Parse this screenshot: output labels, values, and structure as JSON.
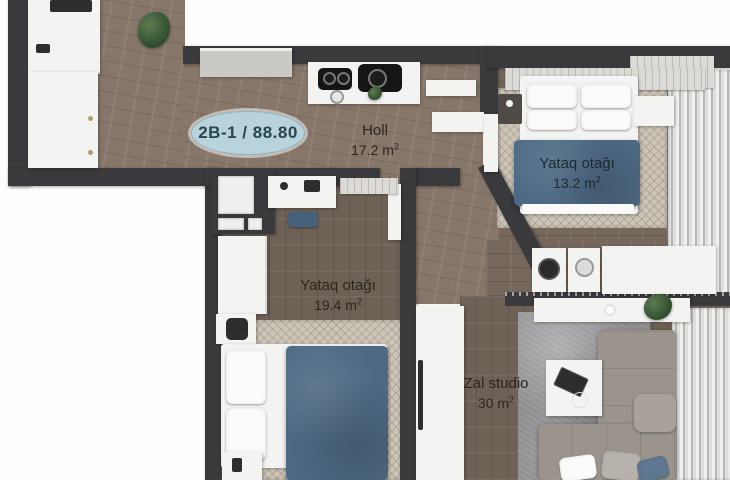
{
  "plan": {
    "badge_label": "2B-1 / 88.80",
    "rooms": {
      "holl": {
        "name": "Holl",
        "area": "17.2 m",
        "sup": "2"
      },
      "bedroom_small": {
        "name": "Yataq otağı",
        "area": "13.2 m",
        "sup": "2"
      },
      "bedroom_large": {
        "name": "Yataq otağı",
        "area": "19.4 m",
        "sup": "2"
      },
      "living": {
        "name": "Zal studio",
        "area": "30 m",
        "sup": "2"
      }
    }
  },
  "colors": {
    "wall": "#3a3a3c",
    "wood_hall": "#87766a",
    "wood_bedroom": "#6e6156",
    "wood_living": "#75675c",
    "blanket_blue": "#4d6983",
    "badge_bg": "#b9d3dd",
    "badge_text": "#27454f",
    "label_text": "#2b2620",
    "rug_light": "#cdc5b8",
    "rug_gray": "#8d8d8f",
    "sofa": "#9a948d",
    "furniture_white": "#f3f3f1",
    "curtain_dark": "#b9b8b6",
    "plant_green": "#2e4a2c"
  }
}
